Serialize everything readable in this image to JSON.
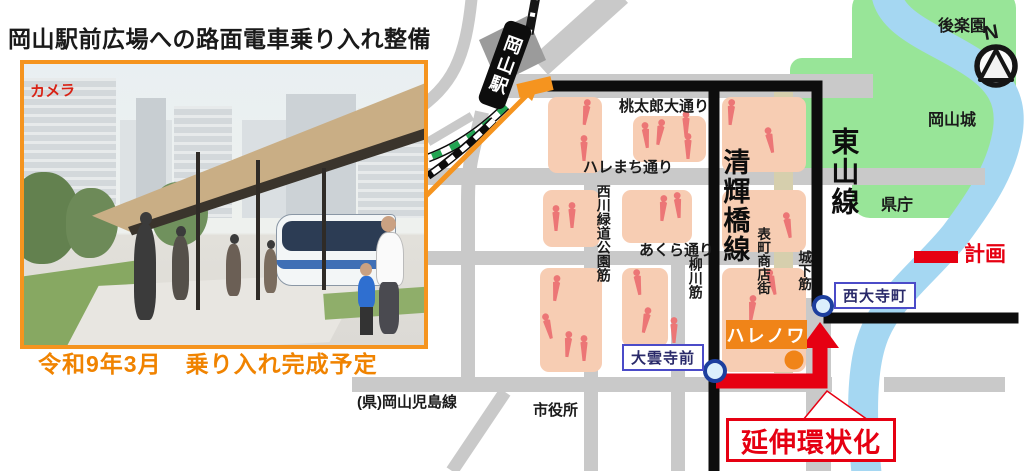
{
  "title": "岡山駅前広場への路面電車乗り入れ整備",
  "photo": {
    "building_sign": "カメラ",
    "caption": "令和9年3月　乗り入れ完成予定"
  },
  "map": {
    "station": "岡山駅",
    "tram_lines": {
      "seikibashi": "清輝橋線",
      "higashiyama": "東山線"
    },
    "streets": {
      "momotaro": "桃太郎大通り",
      "haremachi": "ハレまち通り",
      "nishigawa": "西川緑道公園筋",
      "akura": "あくら通り",
      "yanagawa": "柳川筋",
      "omotecho": "表町商店街",
      "shiroshita": "城下筋"
    },
    "places": {
      "korakuen": "後楽園",
      "okayama_castle": "岡山城",
      "pref_office": "県庁",
      "city_hall": "市役所",
      "pref_road": "(県)岡山児島線",
      "harenowa": "ハレノワ"
    },
    "stops": {
      "saidaijicho": "西大寺町",
      "daiunjimae": "大雲寺前"
    },
    "legend": {
      "plan": "計画"
    },
    "callout": {
      "extension": "延伸環状化"
    },
    "compass": "N",
    "colors": {
      "accent_orange": "#F5941F",
      "plan_red": "#E60012",
      "park_green": "#98E598",
      "river_blue": "#A5D7F2",
      "district_pink": "#F7CDB3",
      "road_gray": "#C9C9C9"
    }
  }
}
